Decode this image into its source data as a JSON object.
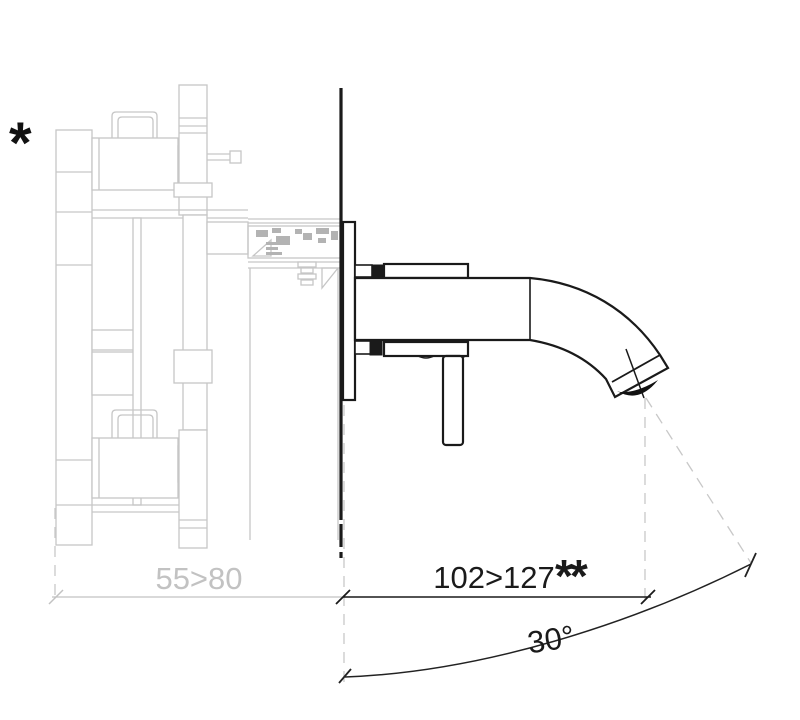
{
  "drawing": {
    "annotations": {
      "footnote_star": "*",
      "footnote_double_star": "**",
      "concealed_depth_range": "55>80",
      "spout_projection_range": "102>127",
      "spout_angle": "30°"
    },
    "colors": {
      "behind_wall_gray": "#c6c6c6",
      "hatch_gray": "#b3b3b3",
      "dim_text_gray": "#c2c2c2",
      "foreground_black": "#1a1a1a",
      "background": "#ffffff"
    }
  }
}
